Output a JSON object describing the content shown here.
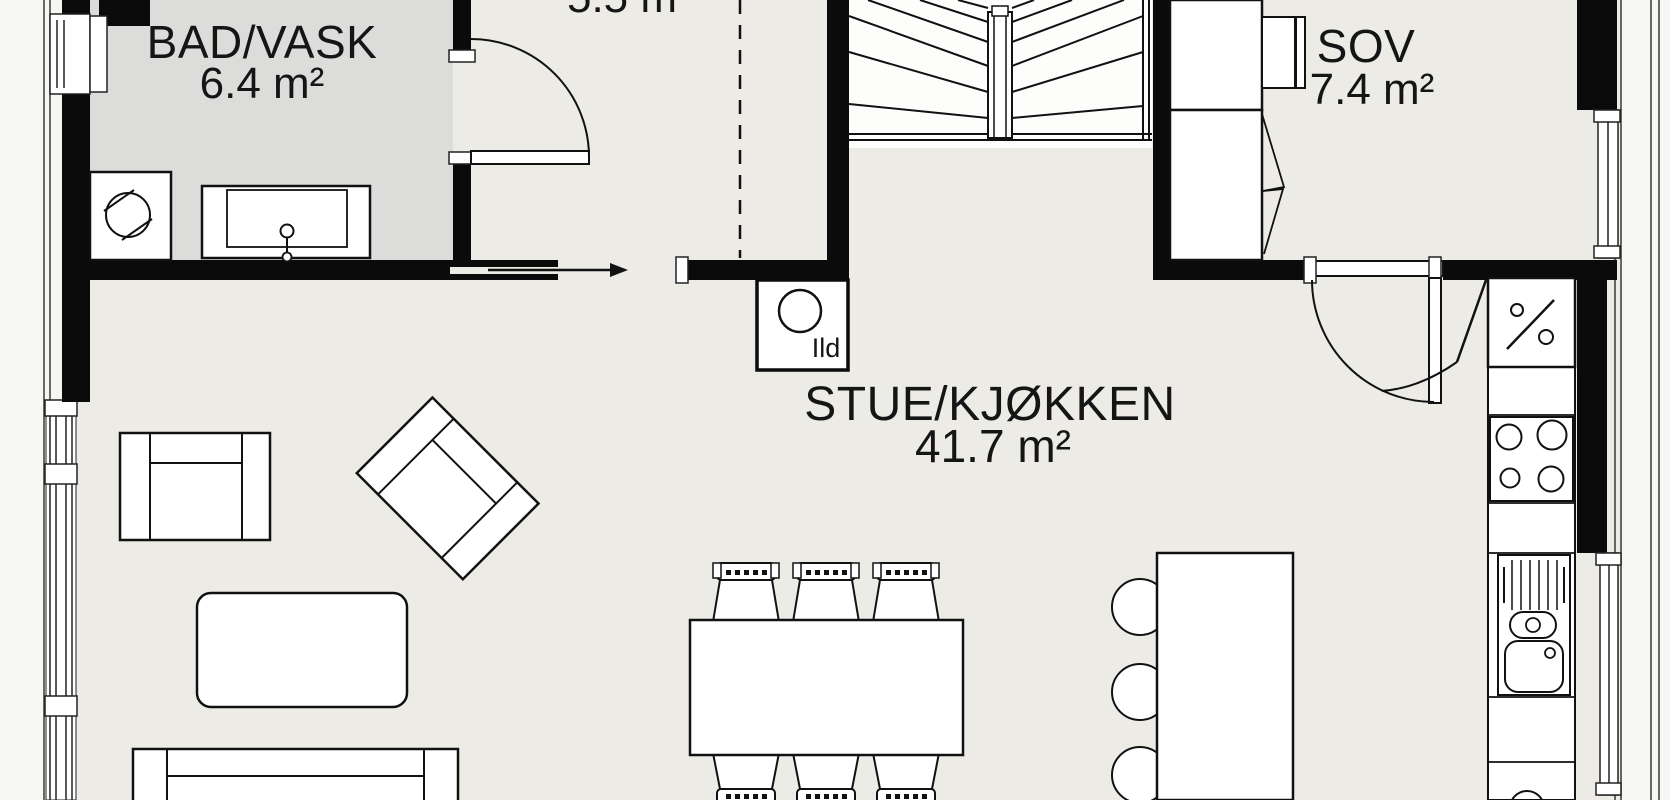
{
  "plan_type": "floor-plan",
  "colors": {
    "floor": "#ECEBE5",
    "bathroom_floor": "#DCDCDA",
    "exterior": "#F6F6F3",
    "wall": "#0B0B0B",
    "line": "#1A1A1A",
    "fixture_fill": "#FFFFFF"
  },
  "rooms": [
    {
      "id": "bathroom",
      "name": "BAD/VASK",
      "area": "6.4 m²"
    },
    {
      "id": "hallway",
      "name": "",
      "area": "5.5 m"
    },
    {
      "id": "bedroom",
      "name": "SOV",
      "area": "7.4 m²"
    },
    {
      "id": "living_kitchen",
      "name": "STUE/KJØKKEN",
      "area": "41.7 m²"
    }
  ],
  "annotations": {
    "fireplace_label": "Ild"
  }
}
